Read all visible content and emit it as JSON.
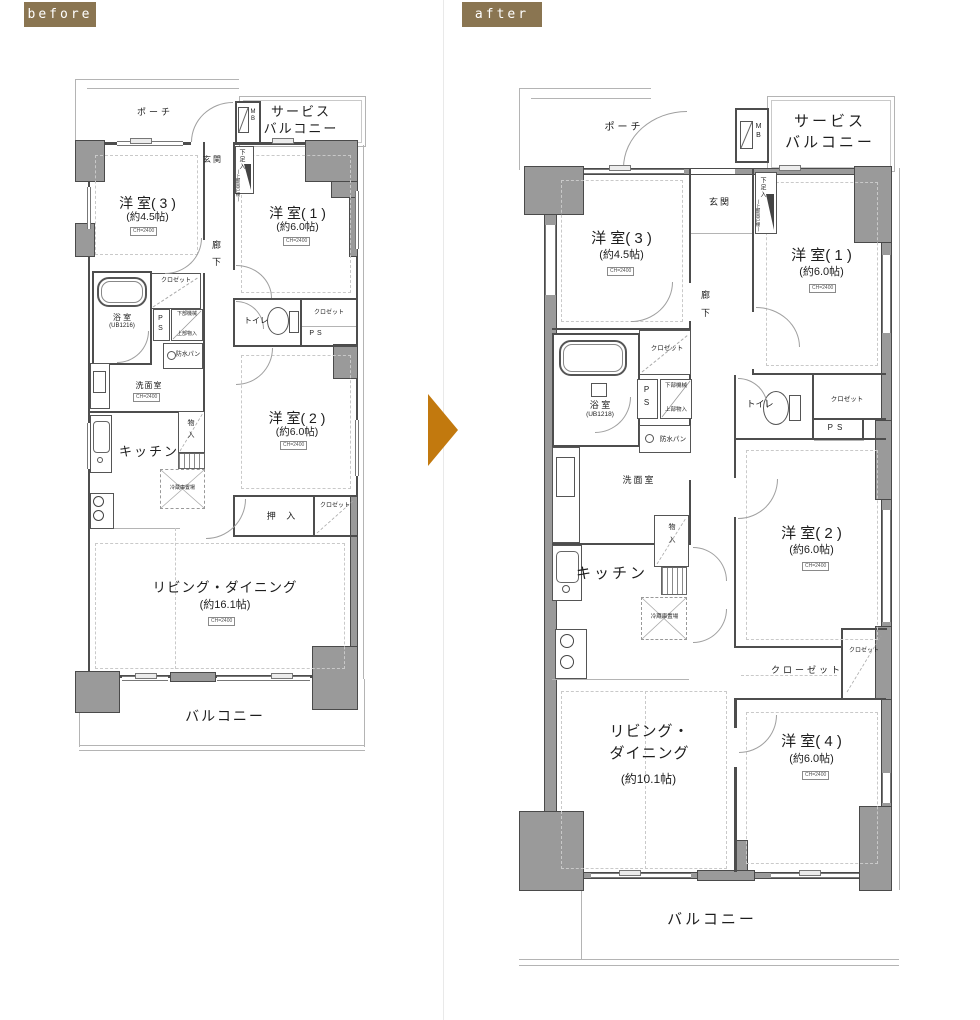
{
  "badges": {
    "before": "before",
    "after": "after"
  },
  "labels": {
    "porch": "ポーチ",
    "service_balcony_1": "サービス",
    "service_balcony_2": "バルコニー",
    "mb": "MB",
    "genkan": "玄関",
    "shoe_box": "下足入",
    "shoe_box_sub": "(上部吊戸棚)",
    "corridor": "廊下",
    "closet": "クロゼット",
    "closet_long": "クローゼット",
    "ps": "PS",
    "lower_machine": "下部機械",
    "upper_storage": "上部物入",
    "bath": "浴 室",
    "waterproof_pan": "防水パン",
    "washroom": "洗面室",
    "toilet": "トイレ",
    "kitchen": "キッチン",
    "fridge": "冷蔵庫置場",
    "storage": "物入",
    "oshiire": "押 入",
    "balcony": "バルコニー",
    "ceiling_tag": "CH=2400"
  },
  "before_plan": {
    "room3_name": "洋 室( 3 )",
    "room3_size": "(約4.5帖)",
    "room1_name": "洋 室( 1 )",
    "room1_size": "(約6.0帖)",
    "room2_name": "洋 室( 2 )",
    "room2_size": "(約6.0帖)",
    "living_name": "リビング・ダイニング",
    "living_size": "(約16.1帖)",
    "bath_model": "(UB1216)"
  },
  "after_plan": {
    "room3_name": "洋 室( 3 )",
    "room3_size": "(約4.5帖)",
    "room1_name": "洋 室( 1 )",
    "room1_size": "(約6.0帖)",
    "room2_name": "洋 室( 2 )",
    "room2_size": "(約6.0帖)",
    "room4_name": "洋 室( 4 )",
    "room4_size": "(約6.0帖)",
    "living_name_1": "リビング・",
    "living_name_2": "ダイニング",
    "living_size": "(約10.1帖)",
    "bath_model": "(UB1218)"
  },
  "colors": {
    "badge": "#8a7551",
    "arrow": "#c2790e"
  }
}
